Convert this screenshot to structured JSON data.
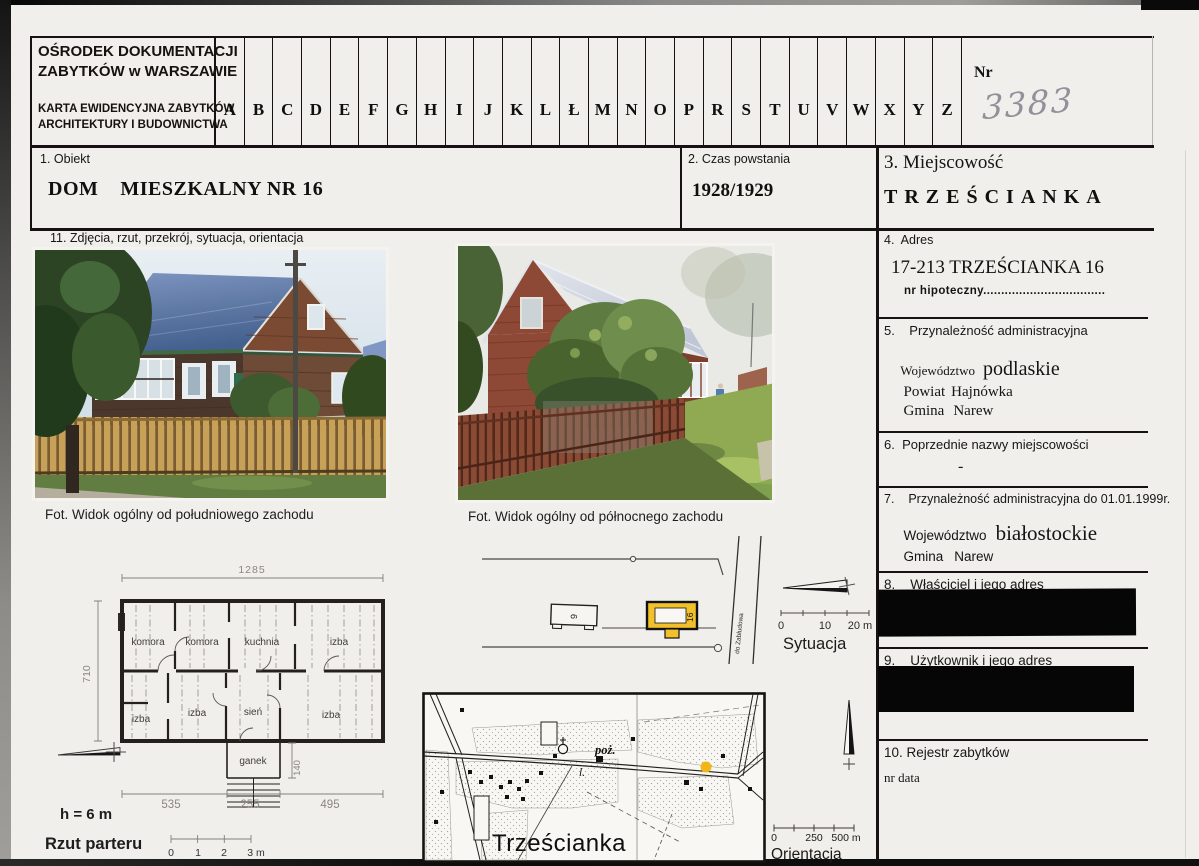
{
  "header": {
    "org_line1": "OŚRODEK DOKUMENTACJI",
    "org_line2": "ZABYTKÓW w WARSZAWIE",
    "card_type_line1": "KARTA EWIDENCYJNA ZABYTKÓW",
    "card_type_line2": "ARCHITEKTURY I BUDOWNICTWA",
    "alphabet": [
      "A",
      "B",
      "C",
      "D",
      "E",
      "F",
      "G",
      "H",
      "I",
      "J",
      "K",
      "L",
      "Ł",
      "M",
      "N",
      "O",
      "P",
      "R",
      "S",
      "T",
      "U",
      "V",
      "W",
      "X",
      "Y",
      "Z"
    ],
    "nr_label": "Nr",
    "nr_value": "3383"
  },
  "fields": {
    "obiekt": {
      "label": "1. Obiekt",
      "value": "DOM    MIESZKALNY NR 16"
    },
    "czas": {
      "label": "2. Czas powstania",
      "value": "1928/1929"
    },
    "miejscowosc": {
      "label": "3. Miejscowość",
      "value": "TRZEŚCIANKA"
    },
    "adres": {
      "label": "4.  Adres",
      "value": "17-213 TRZEŚCIANKA 16",
      "sub": "nr hipoteczny.................................."
    },
    "przynaleznosc": {
      "label": "5.    Przynależność administracyjna",
      "rows": [
        {
          "k": "Województwo",
          "v": "podlaskie"
        },
        {
          "k": "Powiat",
          "v": "Hajnówka"
        },
        {
          "k": "Gmina",
          "v": "Narew"
        }
      ]
    },
    "poprzednie": {
      "label": "6.  Poprzednie nazwy miejscowości",
      "value": "-"
    },
    "przynaleznosc1999": {
      "label": "7.    Przynależność administracyjna do 01.01.1999r.",
      "rows": [
        {
          "k": "Województwo",
          "v": "białostockie"
        },
        {
          "k": "Gmina",
          "v": "Narew"
        }
      ]
    },
    "wlasciciel": {
      "label": "8.    Właściciel i jego adres"
    },
    "uzytkownik": {
      "label": "9.    Użytkownik i jego adres"
    },
    "rejestr": {
      "label": "10. Rejestr zabytków",
      "sub": "nr data"
    },
    "zdjecia": {
      "label": "11. Zdjęcia, rzut, przekrój, sytuacja, orientacja"
    }
  },
  "photos": {
    "caption_sw": "Fot. Widok ogólny od południowego zachodu",
    "caption_nw": "Fot. Widok ogólny od północnego zachodu"
  },
  "floor_plan": {
    "dim_top": "1285",
    "dim_left": "710",
    "dim_bottom_left": "535",
    "dim_bottom_mid": "255",
    "dim_bottom_right": "495",
    "dim_porch": "140",
    "room_t1": "komora",
    "room_t2": "komora",
    "room_t3": "kuchnia",
    "room_t4": "izba",
    "room_b1": "izba",
    "room_b2": "izba",
    "room_b3": "sień",
    "room_b4": "izba",
    "porch": "ganek",
    "height_note": "h = 6 m",
    "title": "Rzut parteru",
    "s0": "0",
    "s1": "1",
    "s2": "2",
    "s3": "3 m"
  },
  "situation": {
    "title": "Sytuacja",
    "house_no": "16",
    "outbuilding_no": "9",
    "road_label": "do Zabłudowa",
    "s0": "0",
    "s1": "10",
    "s2": "20 m"
  },
  "orientation": {
    "title": "Orientacja",
    "village": "Trześcianka",
    "label_poz": "poż.",
    "label_l": "l.",
    "s0": "0",
    "s1": "250",
    "s2": "500 m"
  },
  "colors": {
    "highlight_yellow": "#f2c12a",
    "redaction_black": "#060606"
  }
}
